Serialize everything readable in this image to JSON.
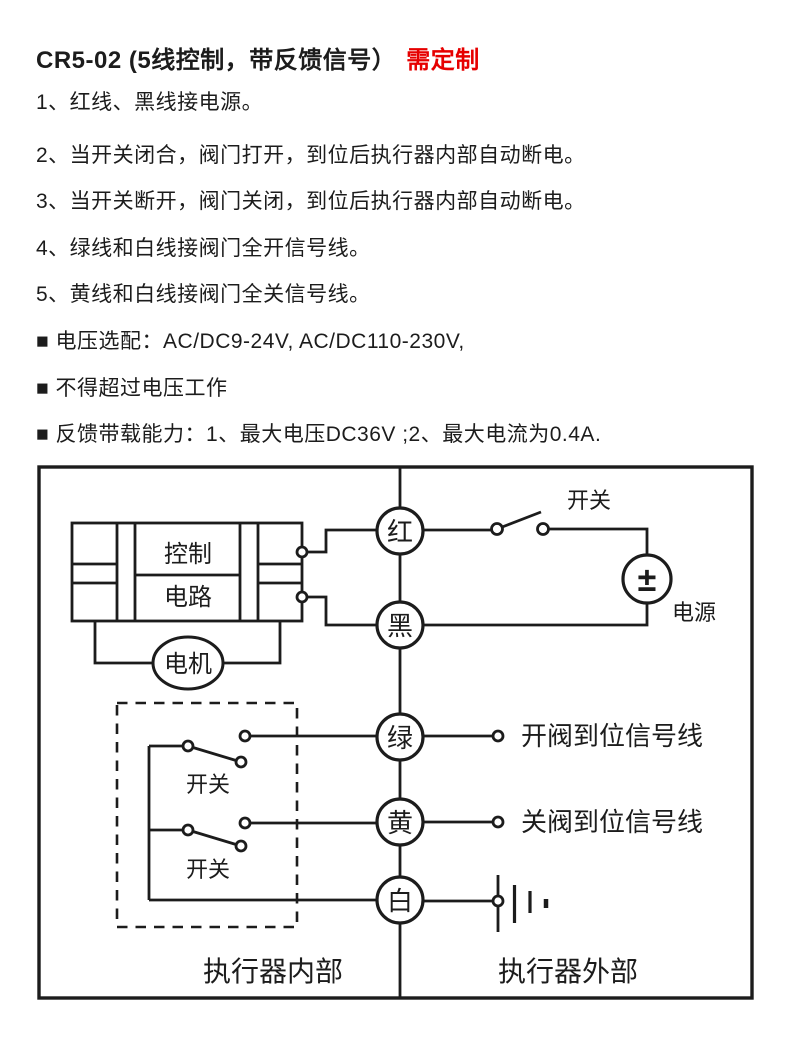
{
  "content": {
    "title": {
      "main": "CR5-02 (5线控制，带反馈信号）",
      "badge": "需定制"
    },
    "notes": [
      "1、红线、黑线接电源。",
      "2、当开关闭合，阀门打开，到位后执行器内部自动断电。",
      "3、当开关断开，阀门关闭，到位后执行器内部自动断电。",
      "4、绿线和白线接阀门全开信号线。",
      "5、黄线和白线接阀门全关信号线。",
      "■ 电压选配：AC/DC9-24V, AC/DC110-230V,",
      "■ 不得超过电压工作",
      "■ 反馈带载能力：1、最大电压DC36V ;2、最大电流为0.4A."
    ]
  },
  "diagram": {
    "wires": {
      "red": "红",
      "black": "黑",
      "green": "绿",
      "yellow": "黄",
      "white": "白"
    },
    "labels": {
      "power_switch": "开关",
      "power_symbol": "±",
      "power_source": "电源",
      "control_line1": "控制",
      "control_line2": "电路",
      "motor": "电机",
      "open_switch": "开关",
      "close_switch": "开关",
      "open_signal": "开阀到位信号线",
      "close_signal": "关阀到位信号线",
      "inside": "执行器内部",
      "outside": "执行器外部"
    },
    "colors": {
      "line": "#1c1c1c",
      "highlight": "#e60000",
      "background": "#ffffff"
    }
  }
}
